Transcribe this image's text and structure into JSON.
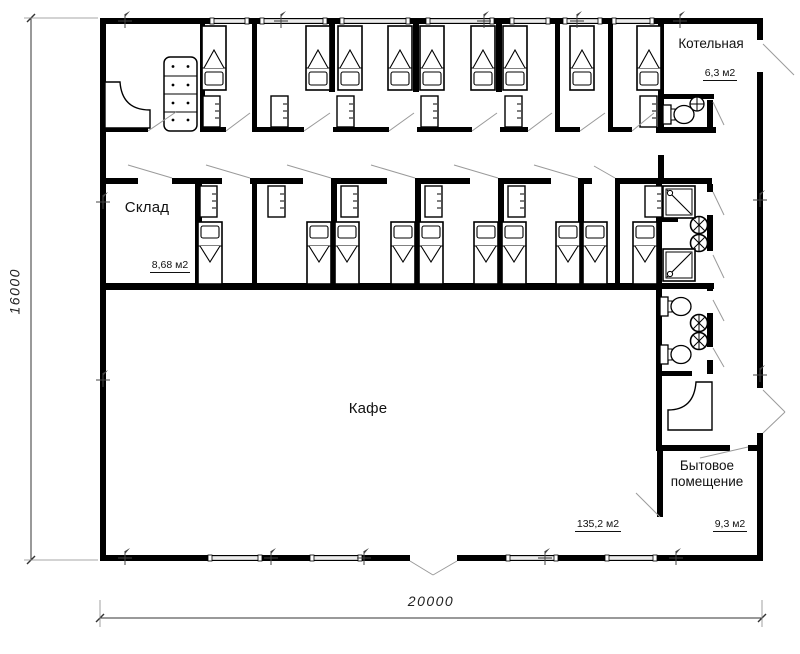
{
  "plan": {
    "rooms": {
      "boiler": {
        "label": "Котельная",
        "area": "6,3 м2"
      },
      "storage": {
        "label": "Склад",
        "area": "8,68 м2"
      },
      "cafe": {
        "label": "Кафе",
        "area": "135,2 м2"
      },
      "utility": {
        "label": "Бытовое помещение",
        "area": "9,3 м2"
      }
    },
    "dimensions": {
      "horizontal": "20000",
      "vertical": "16000"
    },
    "colors": {
      "wall": "#000000",
      "window": "#b3b3b3",
      "door_swing": "#9a9a9a",
      "dimension": "#333333",
      "marker": "#444444",
      "background": "#ffffff"
    },
    "icons": [
      "bed-icon",
      "nightstand-icon",
      "sofa-icon",
      "reception-desk-icon",
      "toilet-icon",
      "sink-icon",
      "double-sink-icon",
      "shower-icon",
      "counter-icon",
      "axis-marker-icon"
    ]
  }
}
